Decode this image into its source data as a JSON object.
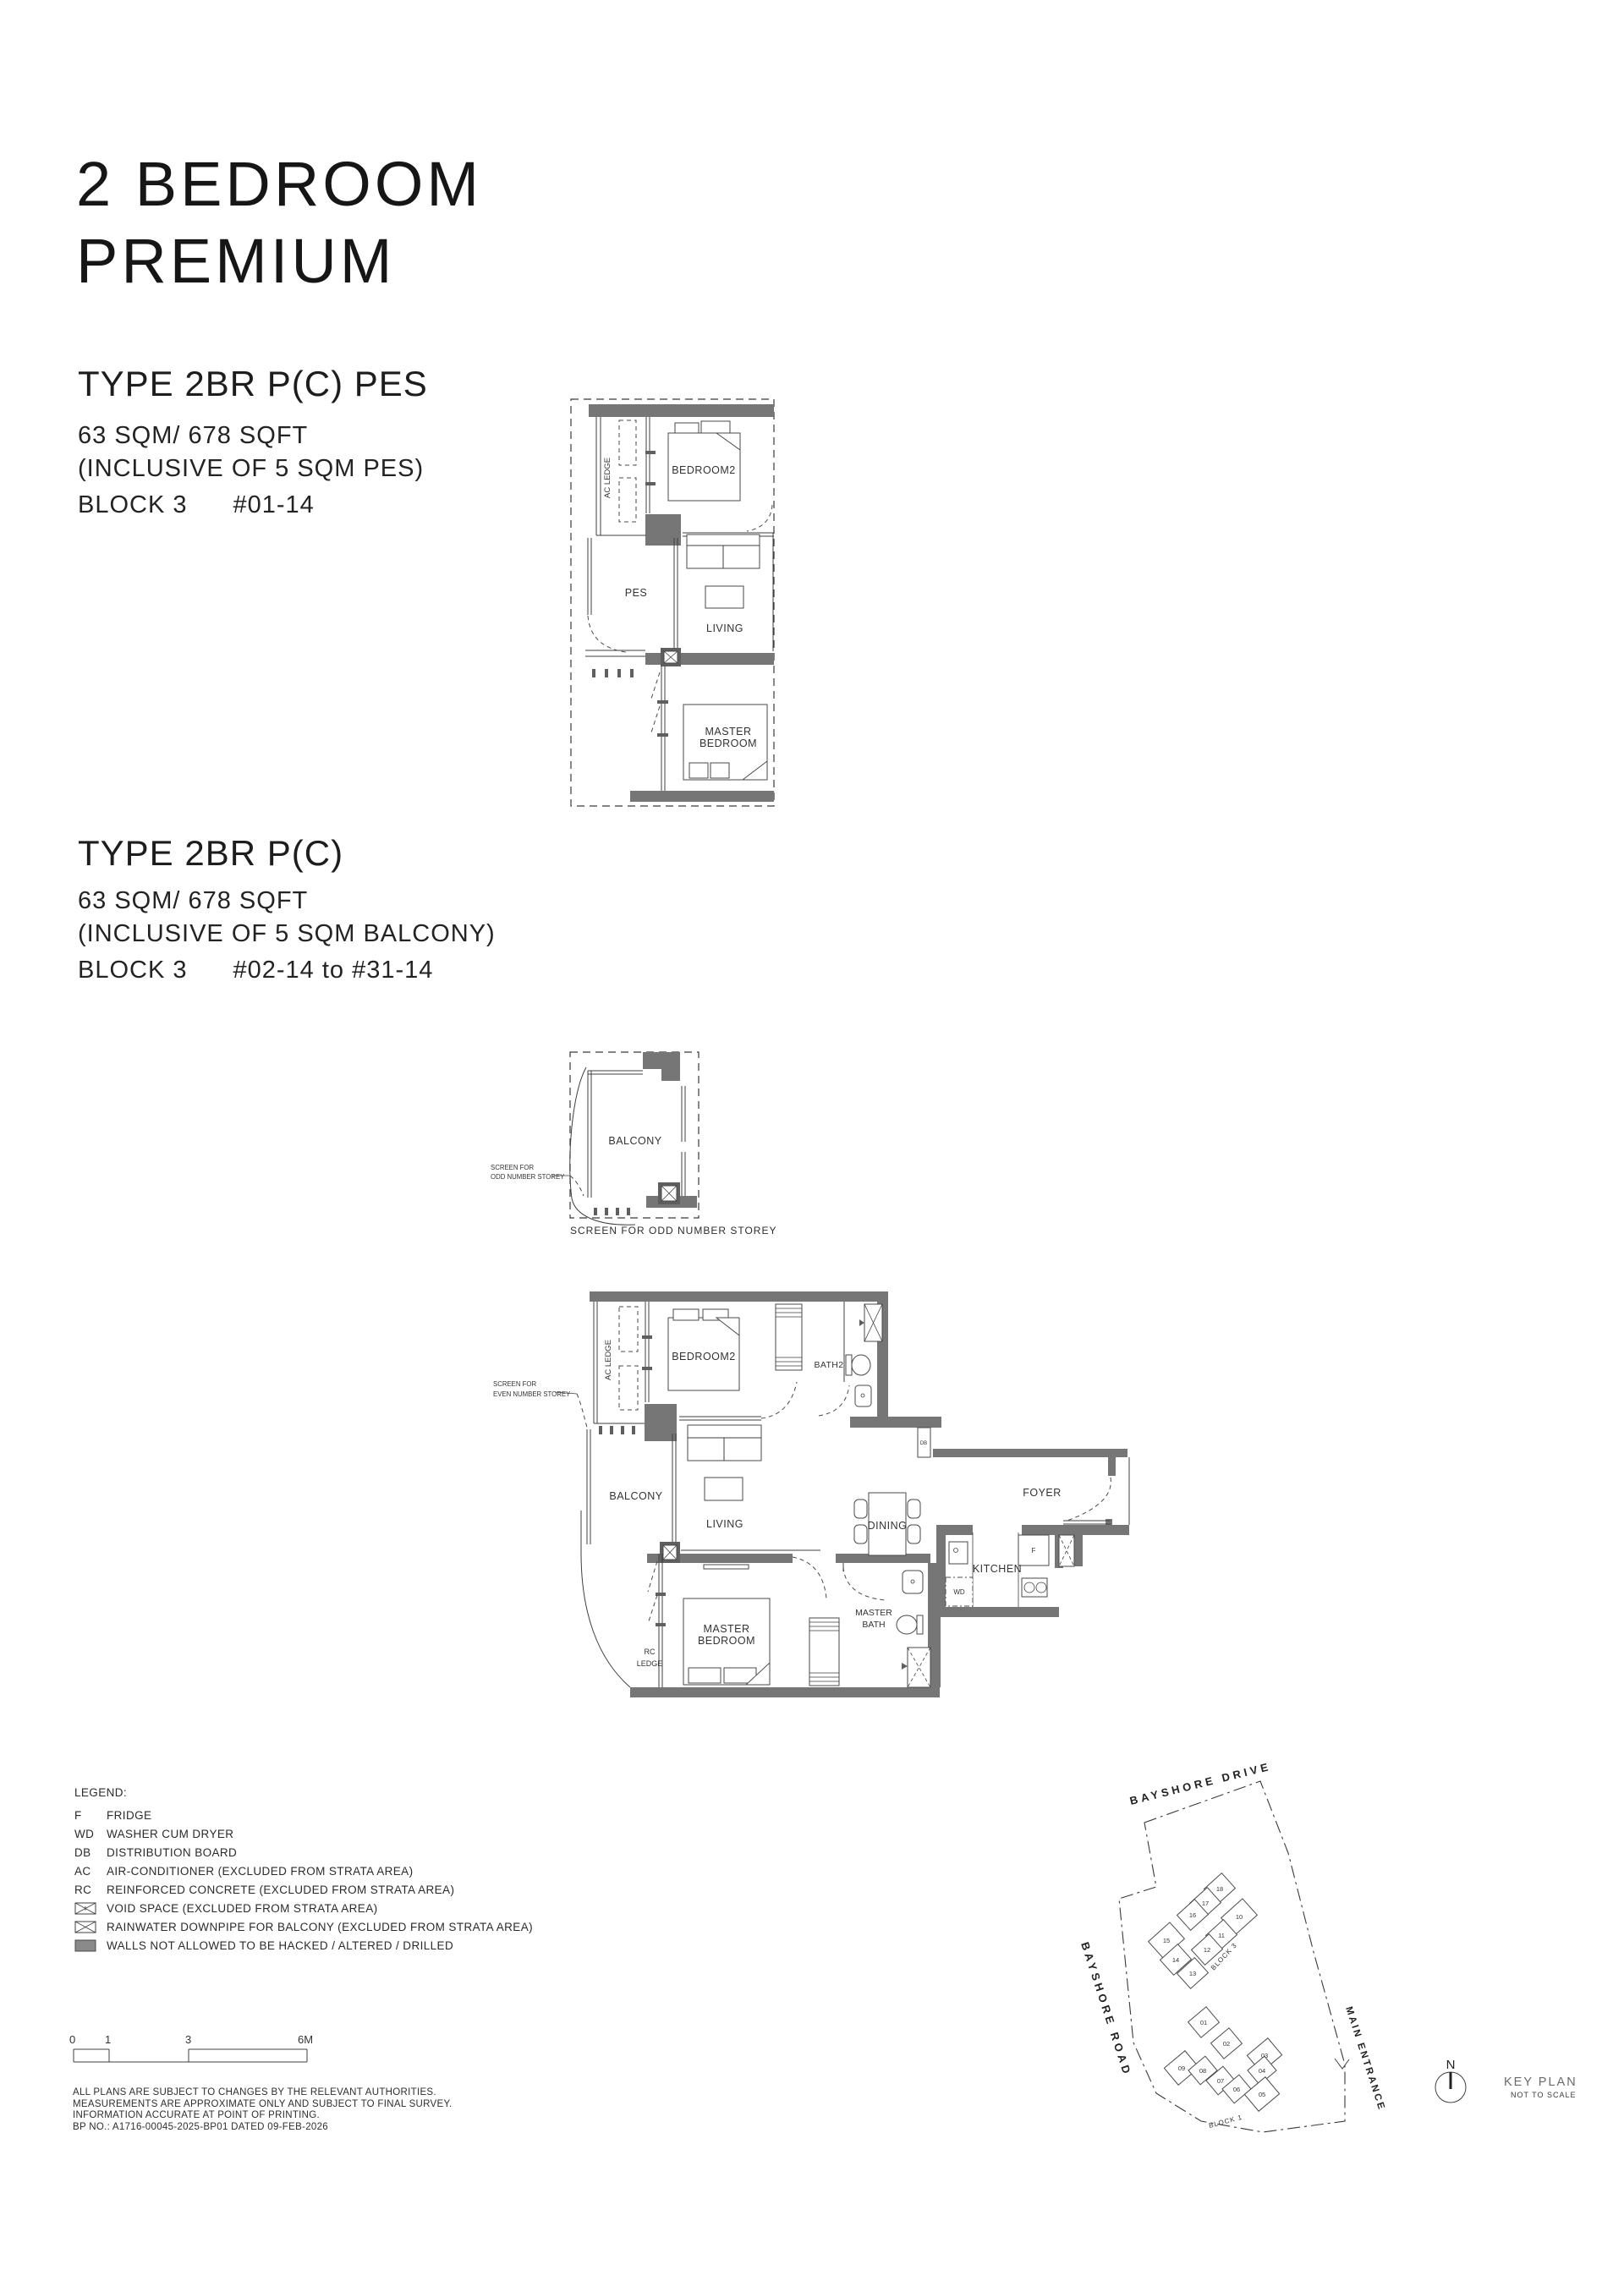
{
  "page": {
    "title_line1": "2 BEDROOM",
    "title_line2": "PREMIUM"
  },
  "unit_types": {
    "pes": {
      "name": "TYPE 2BR P(C) PES",
      "area": "63 SQM/ 678 SQFT",
      "inclusive": "(INCLUSIVE OF 5 SQM PES)",
      "block": "BLOCK 3",
      "units": "#01-14"
    },
    "standard": {
      "name": "TYPE 2BR P(C)",
      "area": "63 SQM/ 678 SQFT",
      "inclusive": "(INCLUSIVE OF 5 SQM BALCONY)",
      "block": "BLOCK 3",
      "units": "#02-14 to #31-14"
    }
  },
  "plan_pes": {
    "rooms": {
      "ac_ledge": "AC LEDGE",
      "bedroom2": "BEDROOM2",
      "pes": "PES",
      "living": "LIVING",
      "master_1": "MASTER",
      "master_2": "BEDROOM"
    }
  },
  "balcony_detail": {
    "room": "BALCONY",
    "annotation_line1": "SCREEN FOR",
    "annotation_line2": "ODD NUMBER STOREY",
    "caption": "SCREEN FOR ODD NUMBER STOREY"
  },
  "plan_main": {
    "annotation_line1": "SCREEN FOR",
    "annotation_line2": "EVEN NUMBER STOREY",
    "rooms": {
      "ac_ledge": "AC LEDGE",
      "bedroom2": "BEDROOM2",
      "bath2": "BATH2",
      "balcony": "BALCONY",
      "living": "LIVING",
      "dining": "DINING",
      "foyer": "FOYER",
      "kitchen": "KITCHEN",
      "master_bath_1": "MASTER",
      "master_bath_2": "BATH",
      "master_1": "MASTER",
      "master_2": "BEDROOM",
      "rc_1": "RC",
      "rc_2": "LEDGE"
    },
    "tags": {
      "db": "DB",
      "f": "F",
      "wd": "WD"
    }
  },
  "legend": {
    "title": "LEGEND:",
    "items": [
      {
        "key": "F",
        "text": "FRIDGE"
      },
      {
        "key": "WD",
        "text": "WASHER CUM DRYER"
      },
      {
        "key": "DB",
        "text": "DISTRIBUTION BOARD"
      },
      {
        "key": "AC",
        "text": "AIR-CONDITIONER (EXCLUDED FROM STRATA AREA)"
      },
      {
        "key": "RC",
        "text": "REINFORCED CONCRETE (EXCLUDED FROM STRATA AREA)"
      },
      {
        "key": "",
        "text": "VOID SPACE (EXCLUDED FROM STRATA AREA)"
      },
      {
        "key": "",
        "text": "RAINWATER DOWNPIPE FOR BALCONY (EXCLUDED FROM STRATA AREA)"
      },
      {
        "key": "",
        "text": "WALLS NOT ALLOWED TO BE HACKED / ALTERED / DRILLED"
      }
    ]
  },
  "scale_bar": {
    "labels": [
      "0",
      "1",
      "3",
      "6M"
    ]
  },
  "disclaimer": {
    "line1": "ALL PLANS ARE SUBJECT TO CHANGES BY THE RELEVANT AUTHORITIES.",
    "line2": "MEASUREMENTS ARE APPROXIMATE ONLY AND SUBJECT TO FINAL SURVEY.",
    "line3": "INFORMATION ACCURATE AT POINT OF PRINTING.",
    "line4": "BP NO.: A1716-00045-2025-BP01  DATED 09-FEB-2026"
  },
  "key_plan": {
    "title": "KEY PLAN",
    "subtitle": "NOT TO SCALE",
    "north": "N",
    "roads": {
      "top": "BAYSHORE DRIVE",
      "left": "BAYSHORE ROAD"
    },
    "entrance": "MAIN ENTRANCE",
    "block3": {
      "label": "BLOCK 3",
      "units": [
        "18",
        "17",
        "16",
        "10",
        "15",
        "11",
        "12",
        "14",
        "13"
      ],
      "highlighted": "14"
    },
    "block1": {
      "label": "BLOCK 1",
      "units": [
        "01",
        "02",
        "03",
        "09",
        "08",
        "07",
        "04",
        "06",
        "05"
      ]
    }
  },
  "colors": {
    "wall": "#767676",
    "line": "#3f3f3f",
    "highlight": "#c4c4c4",
    "text": "#1c1c1c"
  }
}
